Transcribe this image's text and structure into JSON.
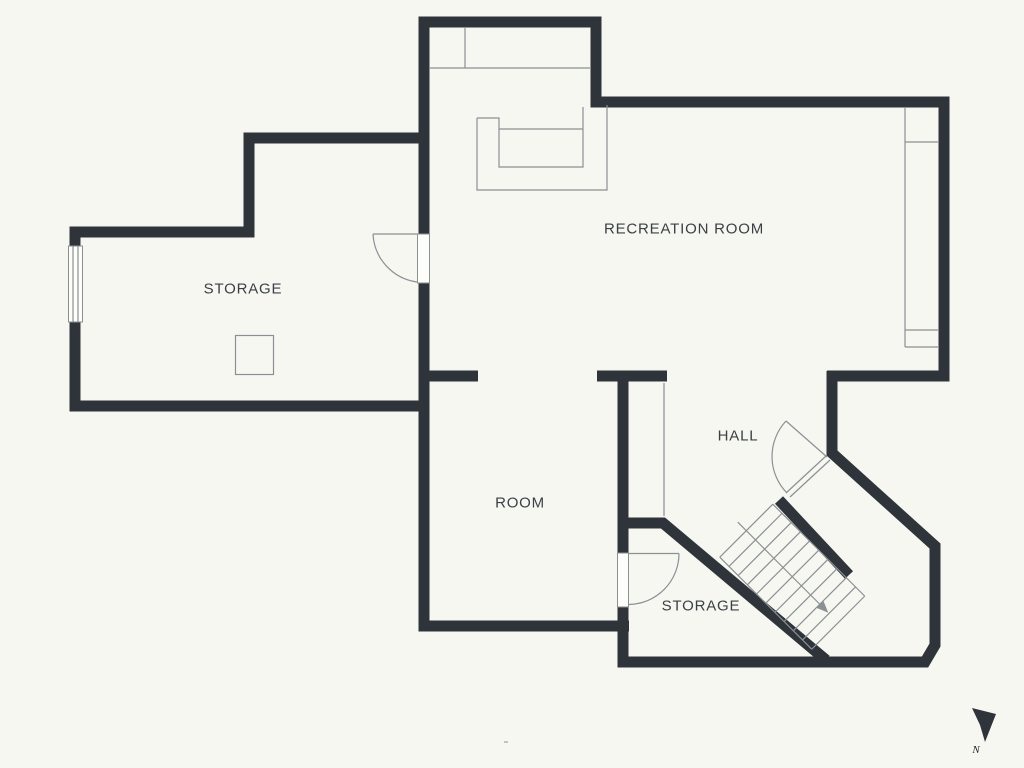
{
  "rooms": {
    "storage_upper": {
      "name": "STORAGE"
    },
    "recreation": {
      "name": "RECREATION ROOM"
    },
    "room": {
      "name": "ROOM"
    },
    "hall": {
      "name": "HALL"
    },
    "storage_lower": {
      "name": "STORAGE"
    }
  },
  "compass": {
    "label": "N"
  },
  "colors": {
    "bg": "#f7f7f1",
    "wall": "#2e343a",
    "thin": "#8b9094",
    "text": "#3b4046"
  }
}
